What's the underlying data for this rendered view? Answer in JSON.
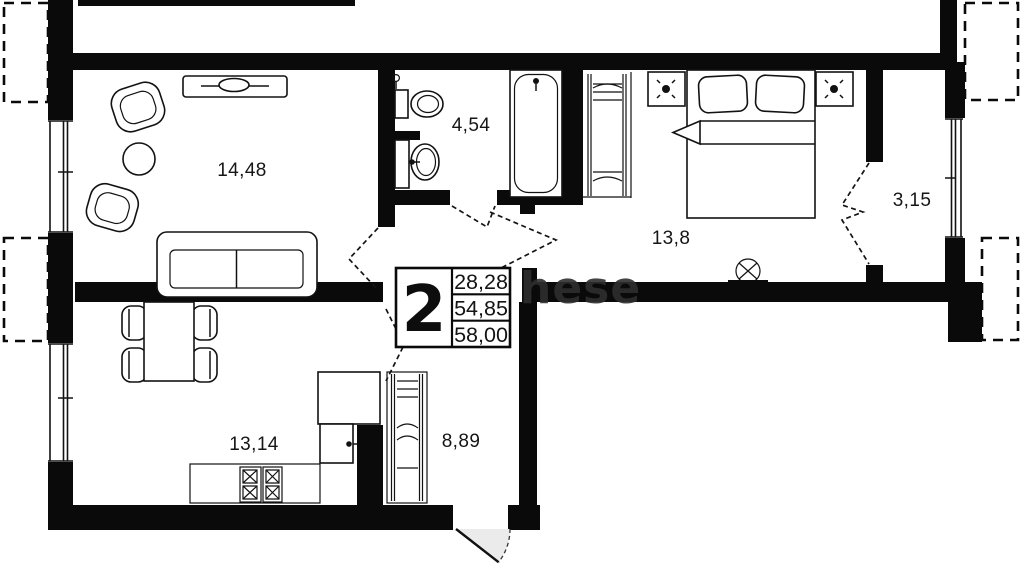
{
  "watermark": "hese",
  "info_box": {
    "type_number": "2",
    "rows": [
      "28,28",
      "54,85",
      "58,00"
    ]
  },
  "rooms": [
    {
      "name": "living-room",
      "label": "14,48"
    },
    {
      "name": "bathroom",
      "label": "4,54"
    },
    {
      "name": "bedroom",
      "label": "13,8"
    },
    {
      "name": "loggia",
      "label": "3,15"
    },
    {
      "name": "kitchen",
      "label": "13,14"
    },
    {
      "name": "hallway",
      "label": "8,89"
    }
  ],
  "colors": {
    "background": "#ffffff",
    "walls": "#0a0a0a",
    "furniture_stroke": "#121212",
    "entrance_door_fill": "#ebebeb",
    "watermark": "#2e2e2e",
    "label_text": "#161616"
  },
  "symbols": [
    "tv-console-icon",
    "armchair-icon",
    "coffee-table-icon",
    "sofa-icon",
    "dining-table-icon",
    "chair-icon",
    "kitchen-counter-icon",
    "stove-icon",
    "fridge-icon",
    "cabinet-icon",
    "hanger-rail-icon",
    "toilet-icon",
    "sink-icon",
    "bathtub-icon",
    "double-bed-icon",
    "nightstand-icon",
    "table-lamp-icon",
    "entrance-door-swing-icon",
    "balcony-door-icon",
    "window-icon",
    "vent-icon"
  ]
}
